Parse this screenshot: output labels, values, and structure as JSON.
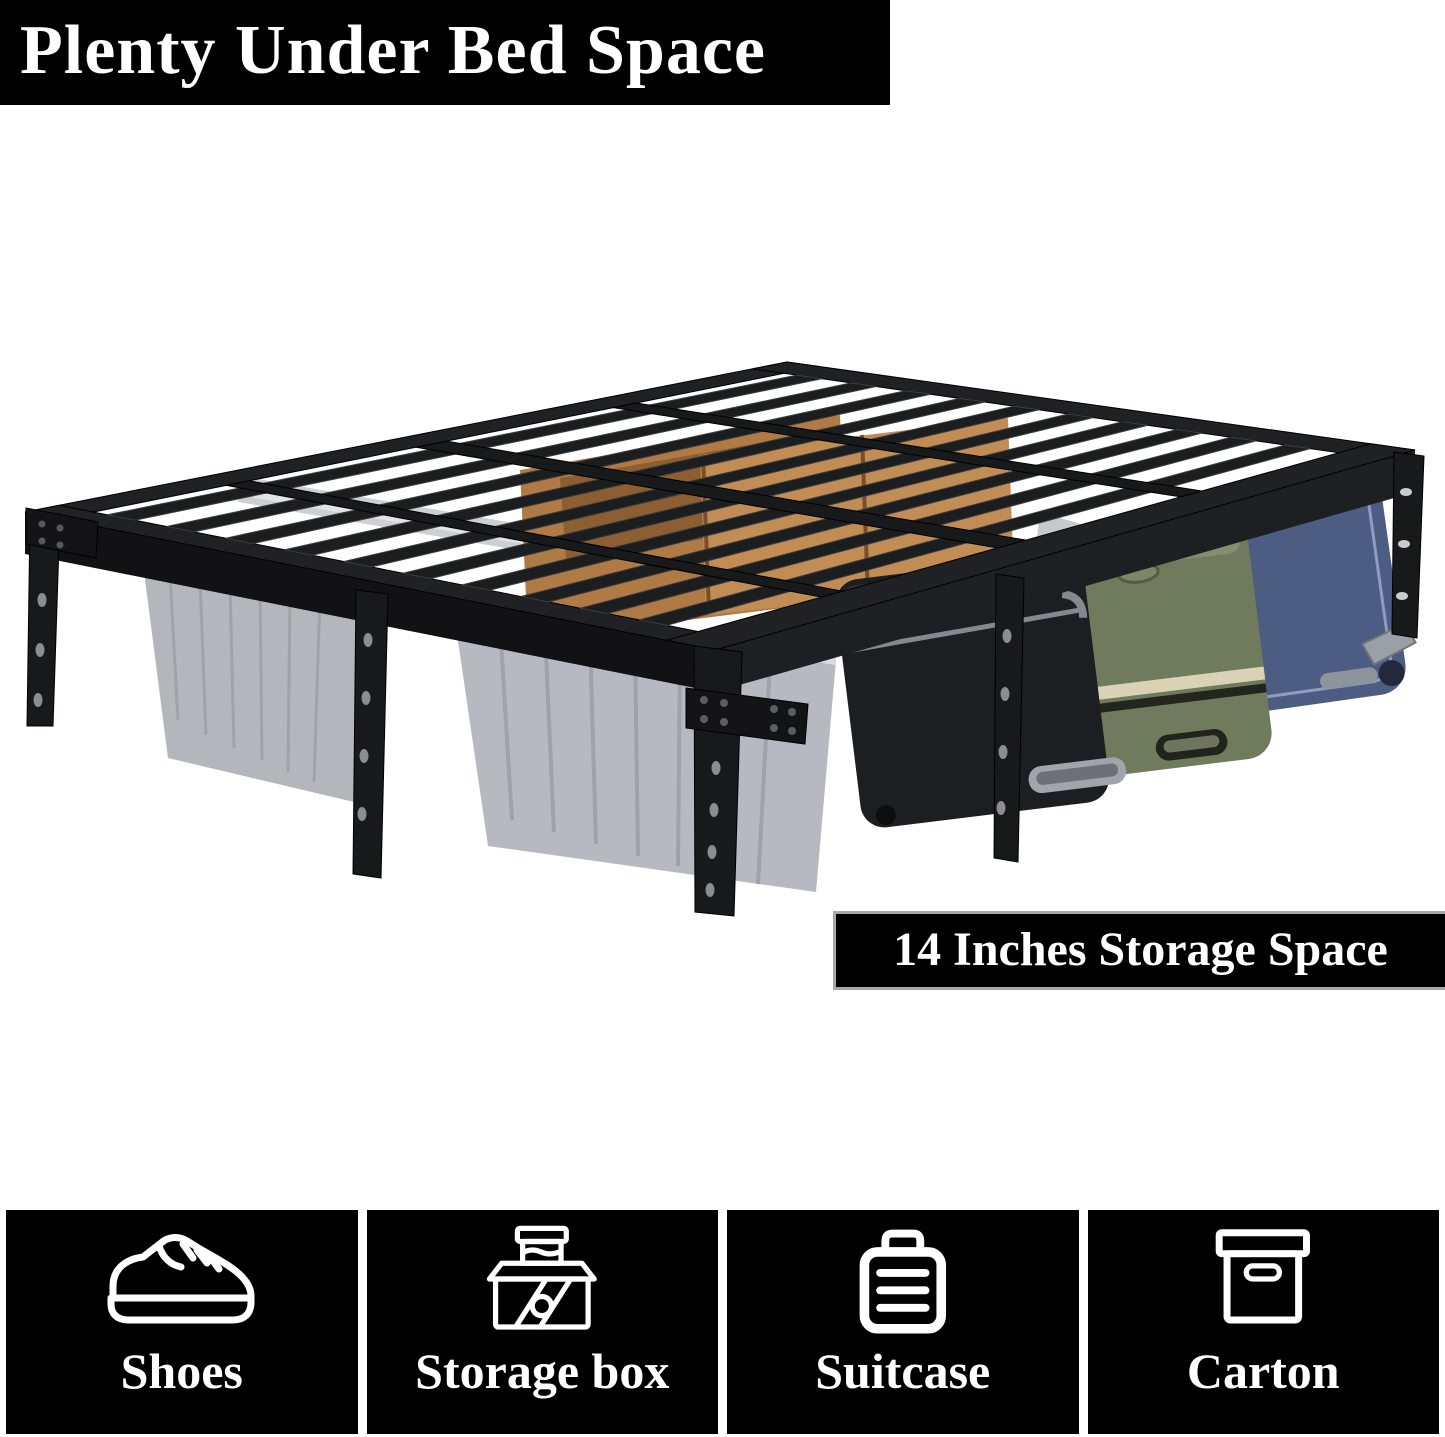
{
  "banner_top": {
    "text": "Plenty Under Bed Space",
    "background": "#000000",
    "text_color": "#ffffff"
  },
  "storage_banner": {
    "text": "14 Inches Storage Space",
    "background": "#000000",
    "text_color": "#ffffff",
    "border_color": "#a8a8a8"
  },
  "photo": {
    "subject": "bed-frame-under-bed-storage",
    "frame_color": "#1c1d1f",
    "bin_color": "#b3b7bc",
    "cardboard_color": "#b57d45",
    "suitcase_colors": {
      "left": "#1d1e21",
      "middle": "#707a5d",
      "right": "#4d5c82"
    }
  },
  "feature_tiles": [
    {
      "label": "Shoes",
      "icon": "shoe-icon"
    },
    {
      "label": "Storage box",
      "icon": "storage-box-icon"
    },
    {
      "label": "Suitcase",
      "icon": "suitcase-icon"
    },
    {
      "label": "Carton",
      "icon": "carton-icon"
    }
  ]
}
